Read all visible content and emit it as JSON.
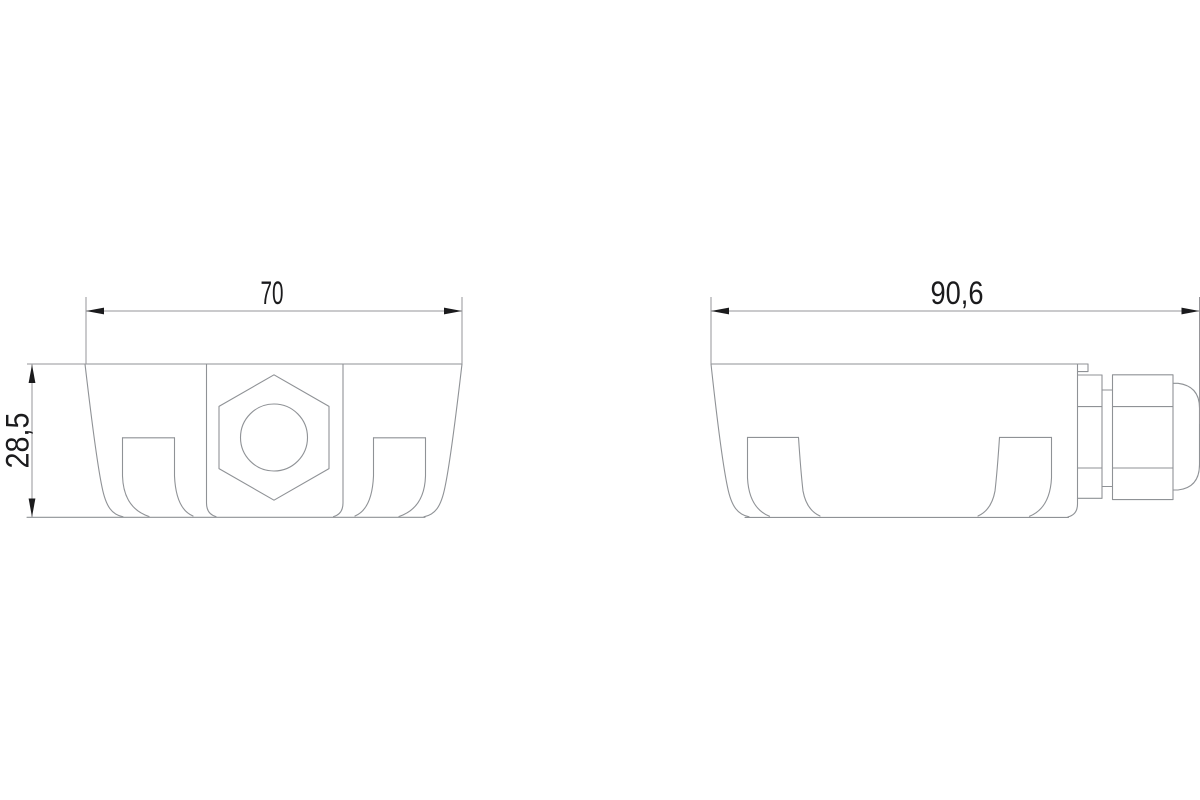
{
  "drawing": {
    "kind": "technical-dimension-drawing",
    "colors": {
      "background": "#ffffff",
      "geometry_line": "#8f9296",
      "dimension_line": "#96969a",
      "annotation": "#1b1b1d"
    },
    "views": {
      "front": {
        "width_dimension": "70",
        "height_dimension": "28,5",
        "elements": [
          "enclosure-body",
          "hex-nut",
          "bore-circle",
          "mounting-foot-left",
          "mounting-foot-right"
        ]
      },
      "side": {
        "width_dimension": "90,6",
        "elements": [
          "enclosure-body",
          "mounting-foot-left",
          "mounting-foot-right",
          "cable-gland-nut",
          "cable-gland-cap",
          "cable-gland-dome"
        ]
      }
    }
  }
}
